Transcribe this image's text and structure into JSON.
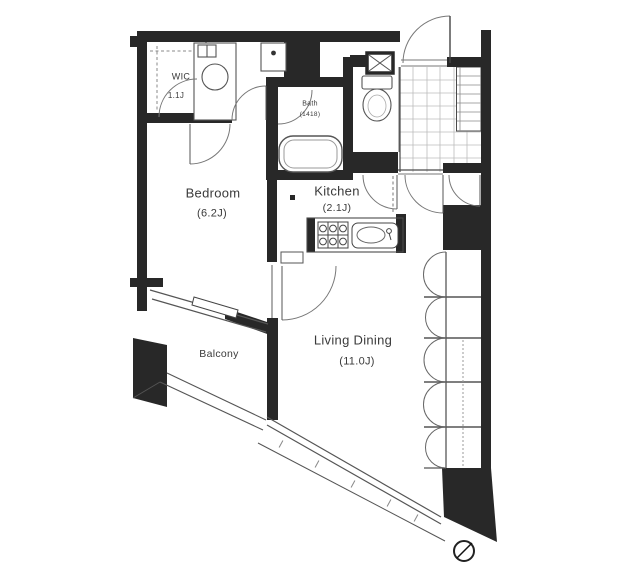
{
  "rooms": {
    "wic": {
      "name": "WIC",
      "size": "1.1J"
    },
    "bath": {
      "name": "Bath",
      "size": "(1418)"
    },
    "bedroom": {
      "name": "Bedroom",
      "size": "(6.2J)"
    },
    "kitchen": {
      "name": "Kitchen",
      "size": "(2.1J)"
    },
    "balcony": {
      "name": "Balcony"
    },
    "living_dining": {
      "name": "Living Dining",
      "size": "(11.0J)"
    }
  },
  "icons": {
    "compass": "north-arrow"
  },
  "colors": {
    "wall": "#282828",
    "line": "#4a4a4a",
    "grid": "#bbbbbb",
    "text": "#3a3a3a",
    "bg": "#ffffff"
  }
}
